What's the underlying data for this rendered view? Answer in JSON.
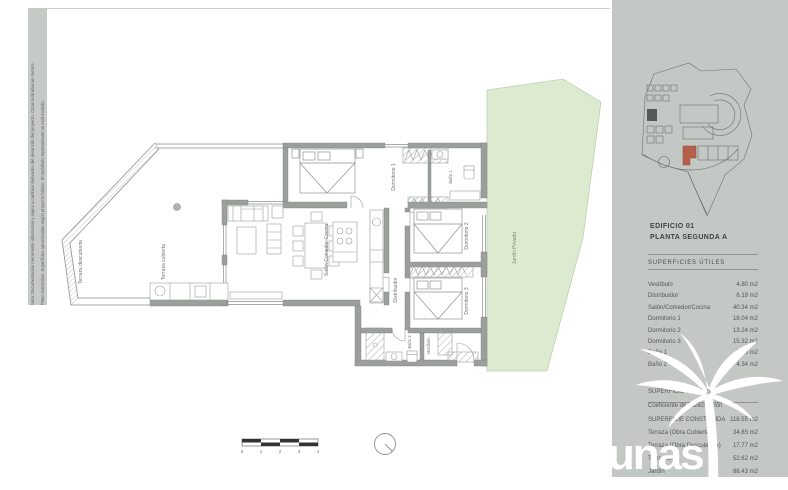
{
  "sheet": {
    "note_1": "Nota: Documentación meramente informativa y sujeta a cambios derivados del desarrollo del proyecto. Cotas indicadas en metros.",
    "note_2": "Plano orientativo. Superficies aproximadas según proyecto básico. El mobiliario representado no está incluido."
  },
  "plan": {
    "labels": {
      "terraza_descubierta": "Terraza descubierta",
      "terraza_cubierta": "Terraza cubierta",
      "salon": "Salón-Comedor-Cocina",
      "dormitorio_1": "Dormitorio 1",
      "bano_1": "Baño 1",
      "dormitorio_2": "Dormitorio 2",
      "dormitorio_3": "Dormitorio 3",
      "distribuidor": "Distribuidor",
      "bano_2": "Baño 2",
      "vestibulo": "Vestíbulo",
      "jardin": "Jardín Privado"
    },
    "scale_ticks": [
      "0",
      "1",
      "2",
      "3",
      "4"
    ]
  },
  "sidebar": {
    "building": "EDIFICIO 01",
    "floor": "PLANTA SEGUNDA A",
    "areas_title": "SUPERFICIES ÚTILES",
    "useful_areas": [
      {
        "label": "Vestíbulo",
        "value": "4.80 m2"
      },
      {
        "label": "Distribuidor",
        "value": "6.19 m2"
      },
      {
        "label": "Salón/Comedor/Cocina",
        "value": "40.34 m2"
      },
      {
        "label": "Dormitorio 1",
        "value": "18.04 m2"
      },
      {
        "label": "Dormitorio 2",
        "value": "13.24 m2"
      },
      {
        "label": "Dormitorio 3",
        "value": "15.32 m2"
      },
      {
        "label": "Baño 1",
        "value": "5.10 m2"
      },
      {
        "label": "Baño 2",
        "value": "4.34 m2"
      }
    ],
    "totals": [
      {
        "label": "SUPERFICIE ÚTIL TOTAL",
        "value": ""
      },
      {
        "label": "Coeficiente de Participación",
        "value": ""
      },
      {
        "label": "SUPERFICIE CONSTRUIDA",
        "value": "118.55 m2"
      }
    ],
    "exterior_areas": [
      {
        "label": "Terraza (Obra Cubierta)",
        "value": "34.85 m2"
      },
      {
        "label": "Terraza (Obra Descubierta)",
        "value": "17.77 m2"
      },
      {
        "label": "Terrazas",
        "value": "52.62 m2"
      },
      {
        "label": "Jardín",
        "value": "88.43 m2"
      }
    ],
    "logo_text": "dunas"
  },
  "colors": {
    "panel_gray": "#c4c8c4",
    "garden_green": "#dcead0",
    "highlight_unit_red": "#b5604a",
    "wall_gray": "#9ba09c",
    "logo_white": "#ffffff"
  }
}
